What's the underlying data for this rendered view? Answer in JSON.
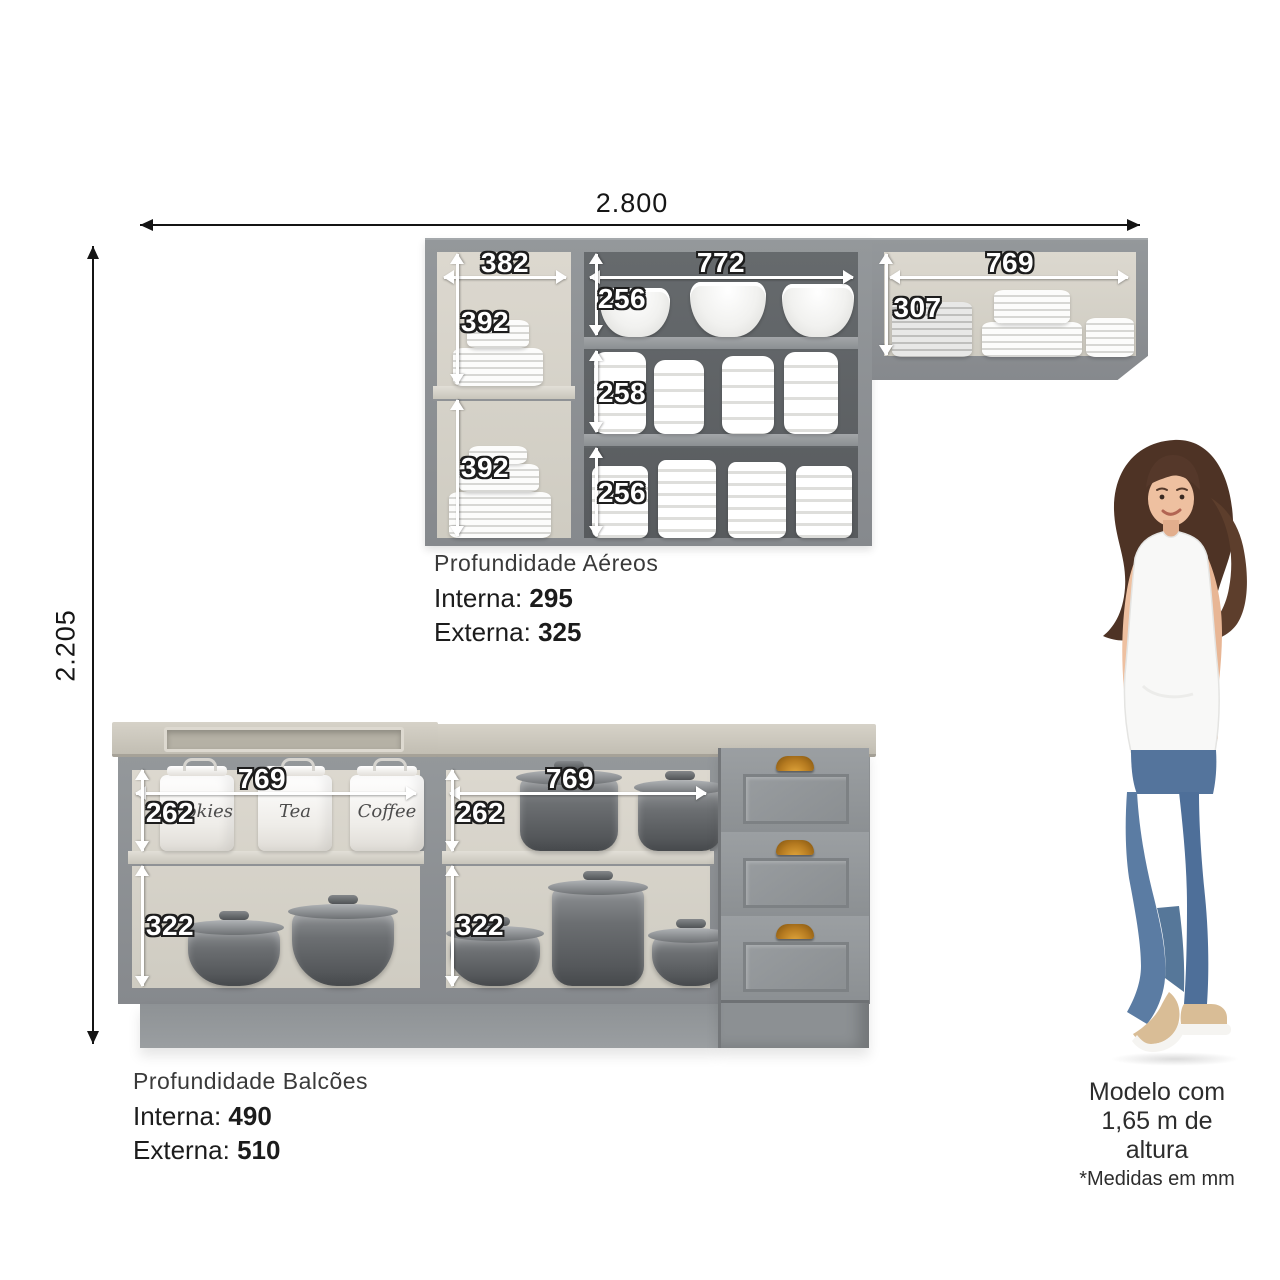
{
  "overall": {
    "width_label": "2.800",
    "height_label": "2.205"
  },
  "upper": {
    "title": "Profundidade Aéreos",
    "interna_label": "Interna:",
    "interna_value": "295",
    "externa_label": "Externa:",
    "externa_value": "325",
    "left_width": "382",
    "left_top": "392",
    "left_bottom": "392",
    "mid_width": "772",
    "mid_top": "256",
    "mid_middle": "258",
    "mid_bottom": "256",
    "right_width": "769",
    "right_height": "307"
  },
  "lower": {
    "title": "Profundidade Balcões",
    "interna_label": "Interna:",
    "interna_value": "490",
    "externa_label": "Externa:",
    "externa_value": "510",
    "left_width": "769",
    "left_top": "262",
    "left_bottom": "322",
    "right_width": "769",
    "right_top": "262",
    "right_bottom": "322",
    "jars": [
      "Cookies",
      "Tea",
      "Coffee"
    ]
  },
  "model": {
    "line1": "Modelo com",
    "line2": "1,65 m de altura",
    "note": "*Medidas em mm"
  },
  "colors": {
    "cabinet_gray": "#8b8f92",
    "interior_dark": "#616467",
    "interior_linen": "#d7d3ca",
    "countertop": "#cac6bb",
    "handle_bronze": "#b57a20",
    "denim_blue": "#5b7ca3",
    "dimension_text_white": "#ffffff",
    "dimension_text_black": "#161616"
  }
}
